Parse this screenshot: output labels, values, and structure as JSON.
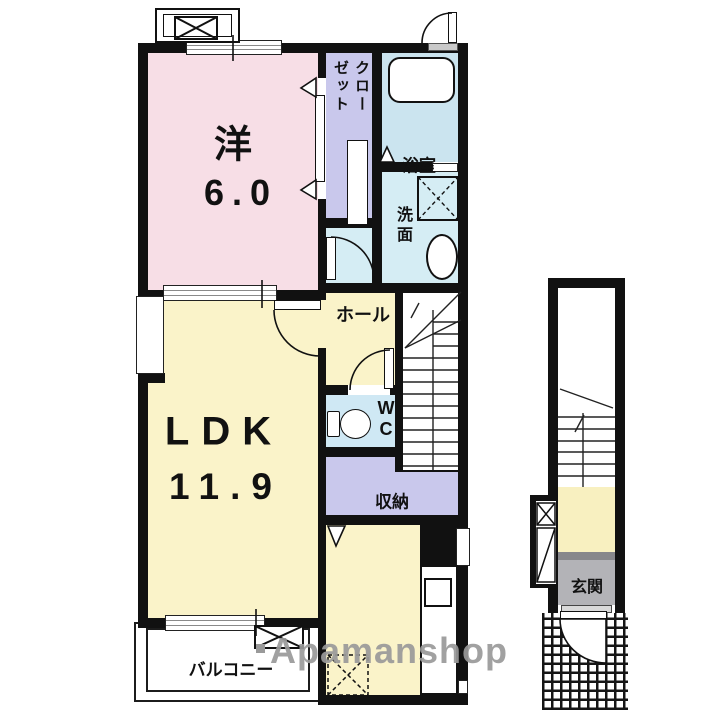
{
  "rooms": {
    "western": {
      "label": "洋",
      "size": "6.0"
    },
    "ldk": {
      "label": "LDK",
      "size": "11.9"
    },
    "closet": {
      "name": "クローゼット",
      "line1": "クロー",
      "line2": "ゼット"
    },
    "bath": {
      "name": "浴室"
    },
    "washroom": {
      "name": "洗面"
    },
    "hall": {
      "name": "ホール"
    },
    "wc": {
      "name": "WC"
    },
    "storage": {
      "name": "収納"
    },
    "balcony": {
      "name": "バルコニー"
    },
    "entrance": {
      "name": "玄関"
    }
  },
  "watermark": {
    "text": "Apamanshop"
  },
  "colors": {
    "wall": "#111111",
    "western_room": "#f7dee6",
    "closet": "#c9c8ec",
    "bath": "#cbe4ef",
    "washroom": "#d5edf4",
    "wc": "#cfe8f4",
    "ldk": "#faf3c9",
    "entrance_gray": "#b3b3b7",
    "watermark_gray": "#9a9a9a"
  }
}
